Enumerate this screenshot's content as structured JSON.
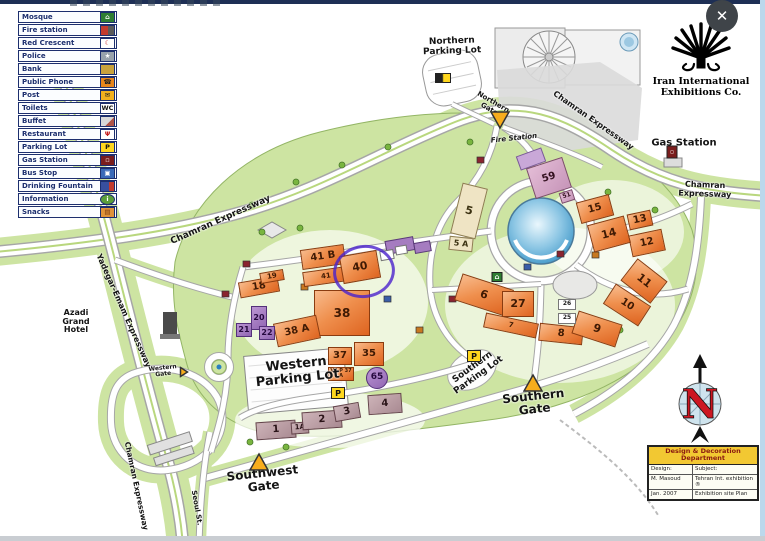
{
  "window": {
    "close_label": "✕"
  },
  "logo": {
    "text": "Iran International\nExhibitions Co."
  },
  "compass": {
    "letter": "N"
  },
  "legend": {
    "items": [
      {
        "label": "Mosque",
        "bg": "#2e7d32",
        "glyph": "⌂",
        "fg": "#ffffff"
      },
      {
        "label": "Fire station",
        "bg": "linear-gradient(90deg,#c23b2e 55%,#5a5a5a 45%)",
        "glyph": "",
        "fg": "#ffffff"
      },
      {
        "label": "Red Crescent",
        "bg": "#ffffff",
        "glyph": "☾",
        "fg": "#c41e1e"
      },
      {
        "label": "Police",
        "bg": "#98a2ac",
        "glyph": "★",
        "fg": "#ffffff"
      },
      {
        "label": "Bank",
        "bg": "#c9a23c",
        "glyph": "",
        "fg": "#3a2a00"
      },
      {
        "label": "Public Phone",
        "bg": "#e8861c",
        "glyph": "☎",
        "fg": "#222222"
      },
      {
        "label": "Post",
        "bg": "#f2b01e",
        "glyph": "✉",
        "fg": "#222222"
      },
      {
        "label": "Toilets",
        "bg": "#ffffff",
        "glyph": "WC",
        "fg": "#111111"
      },
      {
        "label": "Buffet",
        "bg": "linear-gradient(135deg,#d8d8d8 60%,#b05548 40%)",
        "glyph": "",
        "fg": "#ffffff"
      },
      {
        "label": "Restaurant",
        "bg": "#ffffff",
        "glyph": "Ψ",
        "fg": "#c41e1e"
      },
      {
        "label": "Parking Lot",
        "bg": "#ffd71e",
        "glyph": "P",
        "fg": "#111111"
      },
      {
        "label": "Gas Station",
        "bg": "#7a1d1d",
        "glyph": "▫",
        "fg": "#ffffff"
      },
      {
        "label": "Bus Stop",
        "bg": "#3a6ab8",
        "glyph": "▣",
        "fg": "#ffffff"
      },
      {
        "label": "Drinking Fountain",
        "bg": "linear-gradient(90deg,#384f9e 60%,#c23b2e 40%)",
        "glyph": "",
        "fg": "#ffffff"
      },
      {
        "label": "Information",
        "bg": "#5a9e3a",
        "glyph": "i",
        "fg": "#ffffff",
        "round": true
      },
      {
        "label": "Snacks",
        "bg": "#e0933a",
        "glyph": "▤",
        "fg": "#7a3a10"
      }
    ]
  },
  "buildings": [
    {
      "label": "41 B",
      "x": 323,
      "y": 257,
      "w": 44,
      "h": 20,
      "rot": -8,
      "type": "o"
    },
    {
      "label": "41",
      "x": 326,
      "y": 276,
      "w": 46,
      "h": 15,
      "rot": -8,
      "type": "o"
    },
    {
      "label": "40",
      "x": 360,
      "y": 267,
      "w": 38,
      "h": 28,
      "rot": -10,
      "type": "o",
      "fs": 11
    },
    {
      "label": "38",
      "x": 342,
      "y": 313,
      "w": 56,
      "h": 46,
      "rot": 0,
      "type": "o",
      "fs": 12
    },
    {
      "label": "38 A",
      "x": 297,
      "y": 331,
      "w": 44,
      "h": 24,
      "rot": -12,
      "type": "o"
    },
    {
      "label": "37",
      "x": 340,
      "y": 356,
      "w": 24,
      "h": 18,
      "rot": 0,
      "type": "o"
    },
    {
      "label": "35",
      "x": 369,
      "y": 354,
      "w": 30,
      "h": 24,
      "rot": 0,
      "type": "o"
    },
    {
      "label": "V.I.P 37 A",
      "x": 341,
      "y": 374,
      "w": 26,
      "h": 14,
      "rot": 0,
      "type": "o",
      "fs": 5,
      "wrap": true
    },
    {
      "label": "65",
      "x": 377,
      "y": 378,
      "w": 22,
      "h": 22,
      "rot": 0,
      "type": "p",
      "circle": true,
      "fs": 9
    },
    {
      "label": "18",
      "x": 259,
      "y": 287,
      "w": 40,
      "h": 16,
      "rot": -10,
      "type": "o"
    },
    {
      "label": "19",
      "x": 272,
      "y": 276,
      "w": 24,
      "h": 11,
      "rot": -10,
      "type": "o",
      "fs": 7
    },
    {
      "label": "20",
      "x": 259,
      "y": 318,
      "w": 16,
      "h": 24,
      "rot": 0,
      "type": "p",
      "fs": 8
    },
    {
      "label": "21",
      "x": 244,
      "y": 330,
      "w": 16,
      "h": 14,
      "rot": 0,
      "type": "p",
      "fs": 8
    },
    {
      "label": "22",
      "x": 267,
      "y": 333,
      "w": 16,
      "h": 14,
      "rot": 0,
      "type": "p",
      "fs": 8
    },
    {
      "label": "1",
      "x": 276,
      "y": 430,
      "w": 40,
      "h": 18,
      "rot": -4,
      "type": "m"
    },
    {
      "label": "1A",
      "x": 300,
      "y": 428,
      "w": 18,
      "h": 12,
      "rot": -4,
      "type": "m",
      "fs": 7
    },
    {
      "label": "2",
      "x": 322,
      "y": 420,
      "w": 40,
      "h": 18,
      "rot": -4,
      "type": "m"
    },
    {
      "label": "3",
      "x": 347,
      "y": 412,
      "w": 26,
      "h": 16,
      "rot": -10,
      "type": "m"
    },
    {
      "label": "4",
      "x": 385,
      "y": 404,
      "w": 34,
      "h": 20,
      "rot": -4,
      "type": "m"
    },
    {
      "label": "5",
      "x": 469,
      "y": 211,
      "w": 26,
      "h": 52,
      "rot": 14,
      "type": "b",
      "fs": 11
    },
    {
      "label": "5 A",
      "x": 461,
      "y": 244,
      "w": 24,
      "h": 14,
      "rot": 6,
      "type": "b",
      "fs": 8
    },
    {
      "label": "6",
      "x": 484,
      "y": 295,
      "w": 54,
      "h": 28,
      "rot": 18,
      "type": "o",
      "fs": 11
    },
    {
      "label": "27",
      "x": 518,
      "y": 304,
      "w": 32,
      "h": 26,
      "rot": 0,
      "type": "o",
      "fs": 11
    },
    {
      "label": "7",
      "x": 511,
      "y": 325,
      "w": 54,
      "h": 15,
      "rot": 12,
      "type": "o"
    },
    {
      "label": "8",
      "x": 561,
      "y": 334,
      "w": 44,
      "h": 18,
      "rot": 6,
      "type": "o"
    },
    {
      "label": "9",
      "x": 597,
      "y": 329,
      "w": 46,
      "h": 24,
      "rot": 18,
      "type": "o",
      "fs": 11
    },
    {
      "label": "10",
      "x": 627,
      "y": 305,
      "w": 42,
      "h": 24,
      "rot": 33,
      "type": "o"
    },
    {
      "label": "11",
      "x": 644,
      "y": 281,
      "w": 38,
      "h": 28,
      "rot": 38,
      "type": "o",
      "fs": 11
    },
    {
      "label": "12",
      "x": 647,
      "y": 243,
      "w": 34,
      "h": 22,
      "rot": -12,
      "type": "o"
    },
    {
      "label": "13",
      "x": 640,
      "y": 220,
      "w": 24,
      "h": 16,
      "rot": -12,
      "type": "o"
    },
    {
      "label": "14",
      "x": 609,
      "y": 234,
      "w": 38,
      "h": 28,
      "rot": -15,
      "type": "o",
      "fs": 11
    },
    {
      "label": "15",
      "x": 595,
      "y": 209,
      "w": 34,
      "h": 22,
      "rot": -15,
      "type": "o"
    },
    {
      "label": "25",
      "x": 567,
      "y": 318,
      "w": 18,
      "h": 11,
      "rot": 0,
      "type": "w",
      "fs": 6
    },
    {
      "label": "26",
      "x": 567,
      "y": 304,
      "w": 18,
      "h": 11,
      "rot": 0,
      "type": "w",
      "fs": 6
    },
    {
      "label": "59",
      "x": 549,
      "y": 178,
      "w": 38,
      "h": 32,
      "rot": -18,
      "type": "k",
      "fs": 10
    },
    {
      "label": "51",
      "x": 567,
      "y": 196,
      "w": 14,
      "h": 11,
      "rot": -18,
      "type": "k",
      "fs": 6
    }
  ],
  "map_labels": [
    {
      "text": "Northern\nParking Lot",
      "x": 452,
      "y": 47,
      "fs": 9,
      "rot": -2
    },
    {
      "text": "Northern\nGate",
      "x": 491,
      "y": 106,
      "fs": 7,
      "rot": 30
    },
    {
      "text": "Chamran Expressway",
      "x": 221,
      "y": 221,
      "fs": 9,
      "rot": -24
    },
    {
      "text": "Chamran Expressway",
      "x": 593,
      "y": 121,
      "fs": 8,
      "rot": 35
    },
    {
      "text": "Chamran Expressway",
      "x": 705,
      "y": 190,
      "fs": 8,
      "rot": 2
    },
    {
      "text": "Chamran Expressway",
      "x": 136,
      "y": 486,
      "fs": 7.5,
      "rot": 78
    },
    {
      "text": "Yadegar-Emam Expressway",
      "x": 123,
      "y": 311,
      "fs": 8,
      "rot": 66
    },
    {
      "text": "Seoul St.",
      "x": 196,
      "y": 508,
      "fs": 7,
      "rot": 80
    },
    {
      "text": "Azadi\nGrand\nHotel",
      "x": 76,
      "y": 322,
      "fs": 8,
      "rot": 0
    },
    {
      "text": "Gas Station",
      "x": 684,
      "y": 144,
      "fs": 10,
      "rot": 0
    },
    {
      "text": "Fire Station",
      "x": 514,
      "y": 139,
      "fs": 7,
      "rot": -6,
      "italic": true
    },
    {
      "text": "Western\nParking Lot",
      "x": 297,
      "y": 372,
      "fs": 13,
      "rot": -6
    },
    {
      "text": "Southern\nParking Lot",
      "x": 476,
      "y": 372,
      "fs": 9,
      "rot": -36
    },
    {
      "text": "Southwest\nGate",
      "x": 263,
      "y": 480,
      "fs": 12,
      "rot": -6
    },
    {
      "text": "Southern\nGate",
      "x": 534,
      "y": 403,
      "fs": 12,
      "rot": -6
    },
    {
      "text": "Western\nGate",
      "x": 163,
      "y": 372,
      "fs": 6,
      "rot": -6
    }
  ],
  "gates": [
    {
      "name": "northern-gate",
      "x": 500,
      "y": 120,
      "dir": "down",
      "s": 20
    },
    {
      "name": "southern-gate",
      "x": 533,
      "y": 383,
      "dir": "up",
      "s": 20
    },
    {
      "name": "southwest-gate",
      "x": 259,
      "y": 462,
      "dir": "up",
      "s": 20
    },
    {
      "name": "western-gate",
      "x": 184,
      "y": 372,
      "dir": "right",
      "s": 11
    }
  ],
  "map_icons": [
    {
      "name": "parking-icon",
      "glyph": "P",
      "x": 338,
      "y": 393,
      "w": 14,
      "h": 12,
      "bg": "#ffd71e",
      "fg": "#111",
      "fs": 8
    },
    {
      "name": "parking-icon",
      "glyph": "P",
      "x": 474,
      "y": 356,
      "w": 14,
      "h": 12,
      "bg": "#ffd71e",
      "fg": "#111",
      "fs": 8
    },
    {
      "name": "gas-pump-icon",
      "glyph": "▫",
      "x": 672,
      "y": 152,
      "w": 11,
      "h": 13,
      "bg": "#7a1d1d",
      "fg": "#fff",
      "fs": 6
    },
    {
      "name": "mosque-icon",
      "glyph": "⌂",
      "x": 497,
      "y": 277,
      "w": 11,
      "h": 10,
      "bg": "#2e7d32",
      "fg": "#fff",
      "fs": 7
    },
    {
      "name": "car-icon",
      "glyph": "",
      "x": 443,
      "y": 78,
      "w": 16,
      "h": 10,
      "bg": "linear-gradient(90deg,#222 45%,#ffd71e 55%)",
      "fg": "#fff",
      "fs": 6
    }
  ],
  "info_table": {
    "title": "Design & Decoration\nDepartment",
    "rows": [
      [
        "Design:",
        "Subject:"
      ],
      [
        "M. Masoud",
        "Tehran Int. exhibition ®"
      ],
      [
        "Jan. 2007",
        "Exhibition site Plan"
      ]
    ]
  }
}
